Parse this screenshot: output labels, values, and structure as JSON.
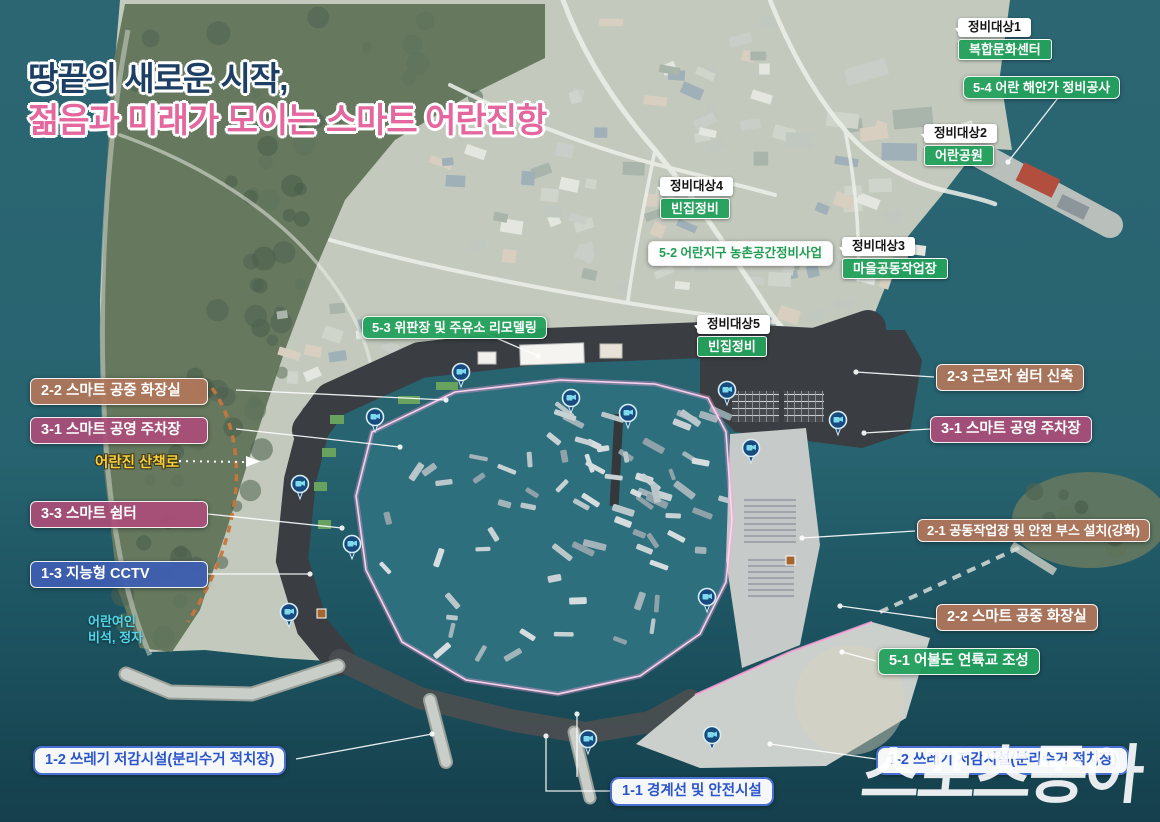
{
  "title": {
    "line1": "땅끝의 새로운 시작,",
    "line2": "젊음과 미래가 모이는 스마트 어란진항"
  },
  "watermark": "스포츠동아",
  "renovation_targets": [
    {
      "tag": "정비대상1",
      "value": "복합문화센터"
    },
    {
      "tag": "정비대상2",
      "value": "어란공원"
    },
    {
      "tag": "정비대상3",
      "value": "마을공동작업장"
    },
    {
      "tag": "정비대상4",
      "value": "빈집정비"
    },
    {
      "tag": "정비대상5",
      "value": "빈집정비"
    }
  ],
  "project_labels": {
    "p5_4": "5-4 어란 해안가 정비공사",
    "p5_3": "5-3 위판장 및 주유소 리모델링",
    "p5_2": "5-2 어란지구 농촌공간정비사업",
    "p5_1": "5-1 어불도 연륙교 조성",
    "p2_3": "2-3 근로자 쉼터 신축",
    "p2_2": "2-2 스마트 공중 화장실",
    "p2_1": "2-1 공동작업장 및 안전 부스 설치(강화)",
    "p3_1": "3-1 스마트 공영 주차장",
    "p3_3": "3-3 스마트 쉼터",
    "p1_3": "1-3 지능형 CCTV",
    "p1_2": "1-2 쓰레기 저감시설(분리수거 적치장)",
    "p1_1": "1-1 경계선 및 안전시설"
  },
  "map_annotations": {
    "trail": "어란진 산책로",
    "monument_line1": "어란여인",
    "monument_line2": "비석, 정자"
  },
  "icons": {
    "cctv_pin": "cctv-camera-pin",
    "trail_arrow": "dashed-arrow-right",
    "facility_marker": "facility-square-marker"
  },
  "colors": {
    "title_line1": "#1d3f63",
    "title_line2": "#e4679e",
    "green_box": "#23a05c",
    "brown_box": "#b1765a",
    "mauve_box": "#ab4d78",
    "navy_box": "#3e5eb0",
    "white_box_blue_text": "#2b55cc",
    "boundary_glow_pink": "#ffb3de",
    "trail_orange": "#c8763c",
    "trail_text_yellow": "#f7cf3d",
    "monument_cyan": "#53d6e8",
    "cctv_pin_blue": "#174a7e"
  }
}
